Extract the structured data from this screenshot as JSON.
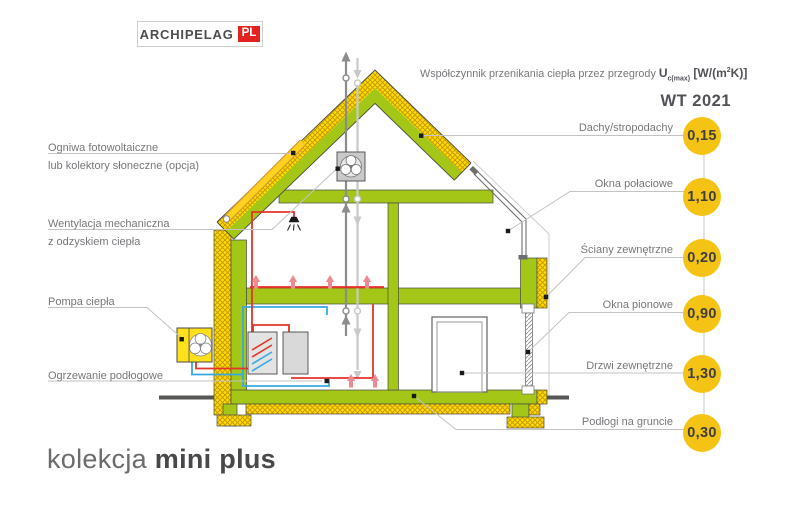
{
  "logo": {
    "brand": "ARCHIPELAG",
    "suffix": "PL"
  },
  "header": {
    "caption": "Współczynnik przenikania ciepła przez przegrody",
    "u_symbol": "U",
    "u_subscript": "c(max)",
    "units_prefix": " [W/(m",
    "units_sup": "2",
    "units_suffix": "K)]",
    "standard": "WT 2021"
  },
  "left_labels": {
    "photovoltaic_line1": "Ogniwa fotowoltaiczne",
    "photovoltaic_line2": "lub kolektory słoneczne (opcja)",
    "ventilation_line1": "Wentylacja mechaniczna",
    "ventilation_line2": "z odzyskiem ciepła",
    "heat_pump": "Pompa ciepła",
    "floor_heating": "Ogrzewanie podłogowe"
  },
  "right_panel": {
    "items": [
      {
        "label": "Dachy/stropodachy",
        "value": "0,15"
      },
      {
        "label": "Okna połaciowe",
        "value": "1,10"
      },
      {
        "label": "Ściany zewnętrzne",
        "value": "0,20"
      },
      {
        "label": "Okna pionowe",
        "value": "0,90"
      },
      {
        "label": "Drzwi zewnętrzne",
        "value": "1,30"
      },
      {
        "label": "Podłogi na gruncie",
        "value": "0,30"
      }
    ]
  },
  "title": {
    "prefix": "kolekcja",
    "name": "mini plus"
  },
  "colors": {
    "structure_green": "#a3c617",
    "insulation_yellow": "#ffdf00",
    "value_circle_yellow": "#f4c313",
    "pipe_red": "#e5332a",
    "pipe_blue": "#36a9e1",
    "arrow_pink": "#ec8b93",
    "logo_red": "#e2231f",
    "label_gray": "#77787b"
  }
}
